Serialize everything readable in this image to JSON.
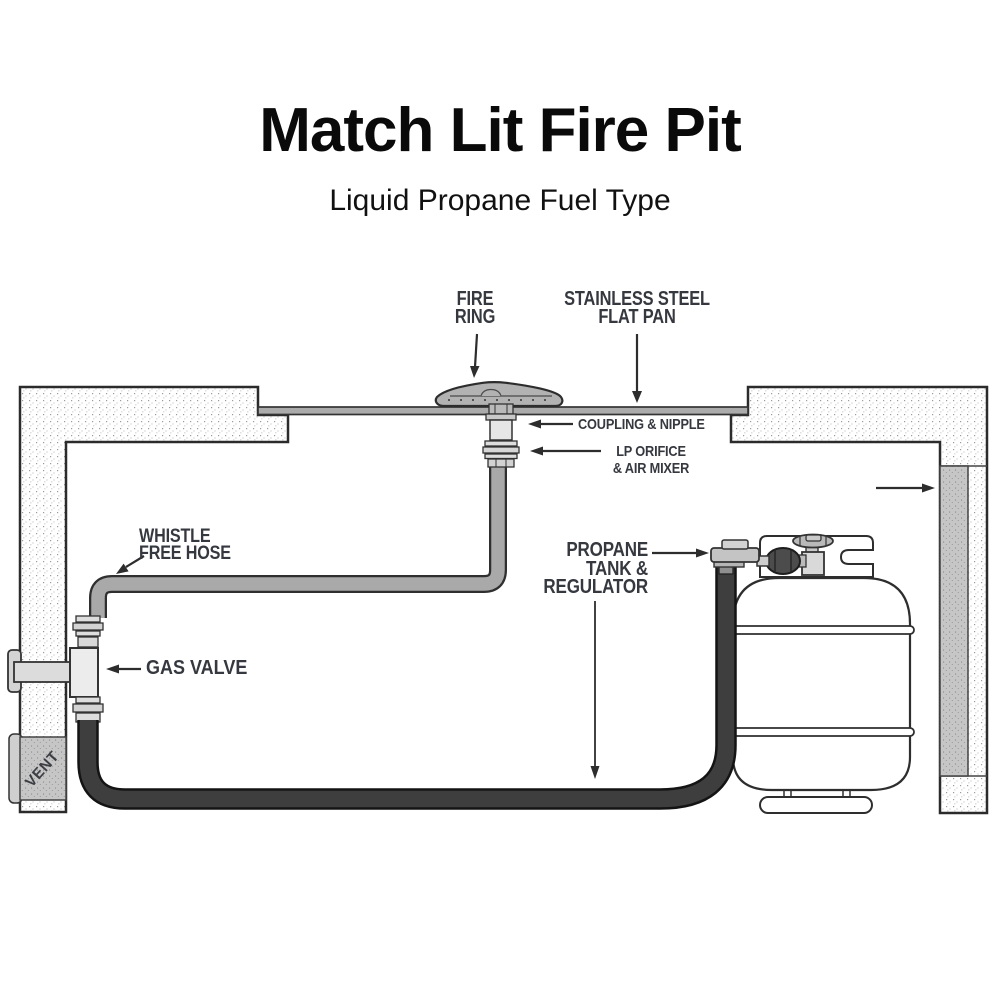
{
  "header": {
    "title": "Match Lit Fire Pit",
    "subtitle": "Liquid Propane Fuel Type"
  },
  "labels": {
    "fire_ring": {
      "line1": "FIRE",
      "line2": "RING"
    },
    "flat_pan": {
      "line1": "STAINLESS STEEL",
      "line2": "FLAT PAN"
    },
    "coupling_nipple": {
      "line1": "COUPLING & NIPPLE"
    },
    "lp_orifice": {
      "line1": "LP ORIFICE",
      "line2": "& AIR MIXER"
    },
    "whistle_hose": {
      "line1": "WHISTLE",
      "line2": "FREE HOSE"
    },
    "gas_valve": {
      "line1": "GAS VALVE"
    },
    "propane_tank": {
      "line1": "PROPANE",
      "line2": "TANK &",
      "line3": "REGULATOR"
    },
    "vent": {
      "line1": "VENT"
    }
  },
  "colors": {
    "diagram_line": "#2d2d2d",
    "label_text": "#35383f",
    "hose_gray": "#a9a9a9",
    "hose_black": "#3e3e3e",
    "pan_gray": "#ababab",
    "metal_light": "#e0e0e0",
    "vent_gray": "#c6c6c6"
  }
}
